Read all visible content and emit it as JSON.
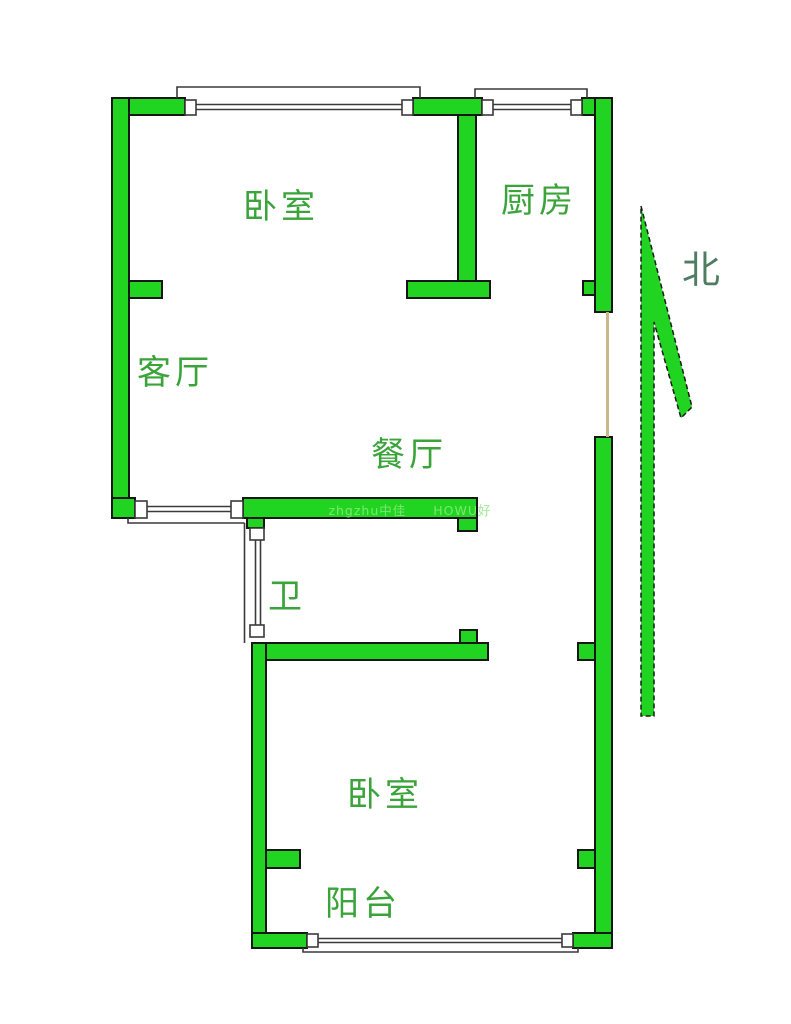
{
  "page": {
    "background": "#ffffff"
  },
  "colors": {
    "wall_fill": "#22d422",
    "wall_outline": "#161616",
    "room_label": "#3aa33a",
    "north_label": "#4f7d62",
    "watermark": "#8ceb7e",
    "window_line": "#3a3a3a",
    "opening_line": "#c9b98a"
  },
  "rooms": [
    {
      "id": "bedroom-top",
      "label": "卧室"
    },
    {
      "id": "kitchen",
      "label": "厨房"
    },
    {
      "id": "living-room",
      "label": "客厅"
    },
    {
      "id": "dining-room",
      "label": "餐厅"
    },
    {
      "id": "bathroom",
      "label": "卫"
    },
    {
      "id": "bedroom-bottom",
      "label": "卧室"
    },
    {
      "id": "balcony",
      "label": "阳台"
    }
  ],
  "compass": {
    "label": "北"
  },
  "watermark": {
    "text": "zhgzhu中佳　　HOWU好"
  }
}
